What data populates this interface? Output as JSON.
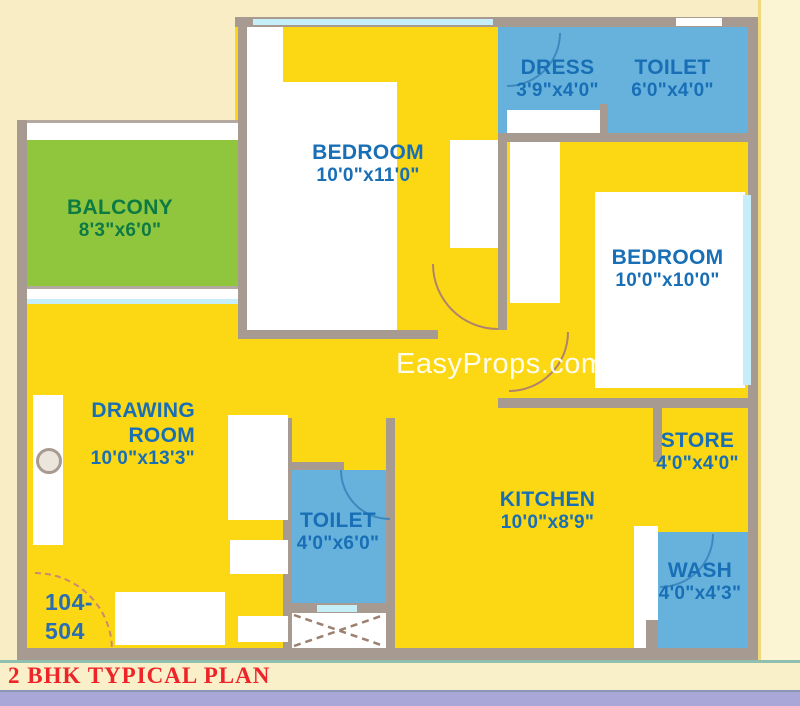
{
  "watermark": "EasyProps.com",
  "unit": {
    "line1": "104-",
    "line2": "504"
  },
  "footer": {
    "title": "2 BHK TYPICAL PLAN"
  },
  "rooms": {
    "balcony": {
      "name": "BALCONY",
      "dims": "8'3\"x6'0\""
    },
    "bedroom1": {
      "name": "BEDROOM",
      "dims": "10'0\"x11'0\""
    },
    "dress": {
      "name": "DRESS",
      "dims": "3'9\"x4'0\""
    },
    "toilet_top": {
      "name": "TOILET",
      "dims": "6'0\"x4'0\""
    },
    "bedroom2": {
      "name": "BEDROOM",
      "dims": "10'0\"x10'0\""
    },
    "drawing_room": {
      "name": "DRAWING ROOM",
      "dims": "10'0\"x13'3\""
    },
    "toilet_mid": {
      "name": "TOILET",
      "dims": "4'0\"x6'0\""
    },
    "kitchen": {
      "name": "KITCHEN",
      "dims": "10'0\"x8'9\""
    },
    "store": {
      "name": "STORE",
      "dims": "4'0\"x4'0\""
    },
    "wash": {
      "name": "WASH",
      "dims": "4'0\"x4'3\""
    }
  },
  "colors": {
    "floor": "#fbd714",
    "wet_room": "#67b2dc",
    "balcony": "#90c63e",
    "wall": "#a69a91",
    "window": "#c6eef8",
    "room_label": "#186fb6",
    "balcony_label": "#0e7a43",
    "title_red": "#ee2429",
    "background": "#f8edc4",
    "footer_strip": "#a8a7d8"
  }
}
